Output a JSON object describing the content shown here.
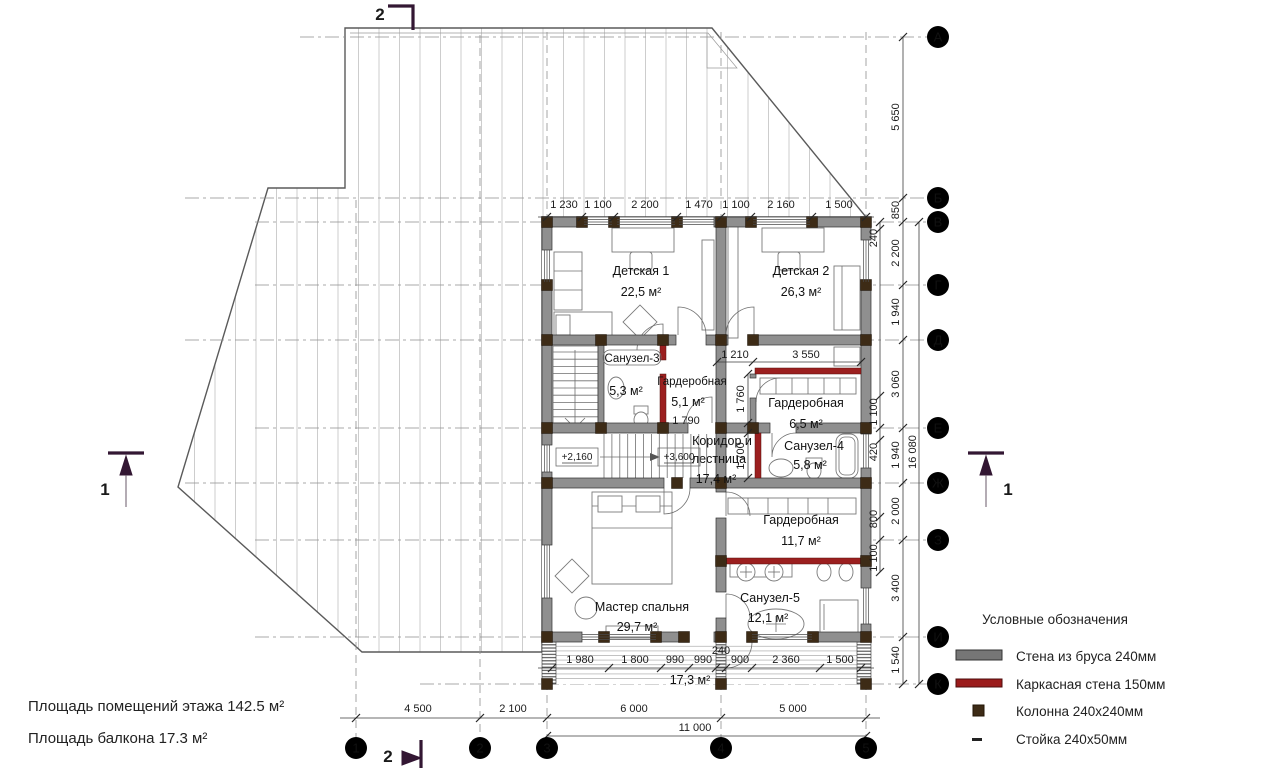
{
  "plan": {
    "rooms": [
      {
        "name": "Детская 1",
        "area": "22,5 м²"
      },
      {
        "name": "Детская 2",
        "area": "26,3 м²"
      },
      {
        "name": "Санузел-3",
        "area": "5,3 м²"
      },
      {
        "name": "Гардеробная",
        "area": "5,1 м²",
        "note": "1 790"
      },
      {
        "name": "Гардеробная",
        "area": "6,5 м²"
      },
      {
        "name": "Коридор и",
        "name2": "лестница",
        "area": "17,4 м²"
      },
      {
        "name": "Санузел-4",
        "area": "5,8 м²"
      },
      {
        "name": "Гардеробная",
        "area": "11,7 м²"
      },
      {
        "name": "Мастер спальня",
        "area": "29,7 м²"
      },
      {
        "name": "Санузел-5",
        "area": "12,1 м²"
      }
    ],
    "balcony_area": "17,3 м²",
    "elevations": [
      "+2,160",
      "+3,600"
    ]
  },
  "dimensions": {
    "top": [
      "1 230",
      "1 100",
      "2 200",
      "1 470",
      "1 100",
      "2 160",
      "1 500"
    ],
    "balcony": [
      "1 980",
      "1 800",
      "990",
      "990",
      "900",
      "2 360",
      "1 500"
    ],
    "balcony_wall": "240",
    "spans": [
      "4 500",
      "2 100",
      "6 000",
      "5 000"
    ],
    "total": "11 000",
    "right": [
      "5 650",
      "850",
      "2 200",
      "1 940",
      "3 060",
      "1 940",
      "2 000",
      "3 400",
      "1 540"
    ],
    "right_sub": [
      "240",
      "1 100",
      "420",
      "800",
      "1 100"
    ],
    "right_total": "16 080",
    "interior": {
      "w1210": "1 210",
      "w3550": "3 550",
      "h1760": "1 760",
      "h1700": "1 700"
    }
  },
  "axes": {
    "rows": [
      "А",
      "Б",
      "В",
      "Г",
      "Д",
      "Е",
      "Ж",
      "З",
      "И",
      "К"
    ],
    "cols": [
      "1",
      "2",
      "3",
      "4",
      "5"
    ]
  },
  "sections": {
    "top": "2",
    "bottom": "2",
    "left": "1",
    "right": "1"
  },
  "legend": {
    "title": "Условные обозначения",
    "items": [
      {
        "label": "Стена из бруса 240мм"
      },
      {
        "label": "Каркасная стена 150мм"
      },
      {
        "label": "Колонна 240x240мм"
      },
      {
        "label": "Стойка 240x50мм"
      }
    ]
  },
  "notes": [
    "Площадь помещений этажа 142.5 м²",
    "Площадь балкона 17.3 м²"
  ],
  "colors": {
    "wall_gray": "#8f8f8f",
    "wall_frame_red": "#9b1f1f",
    "column_brown": "#3d2b16",
    "section_marker": "#331733"
  }
}
